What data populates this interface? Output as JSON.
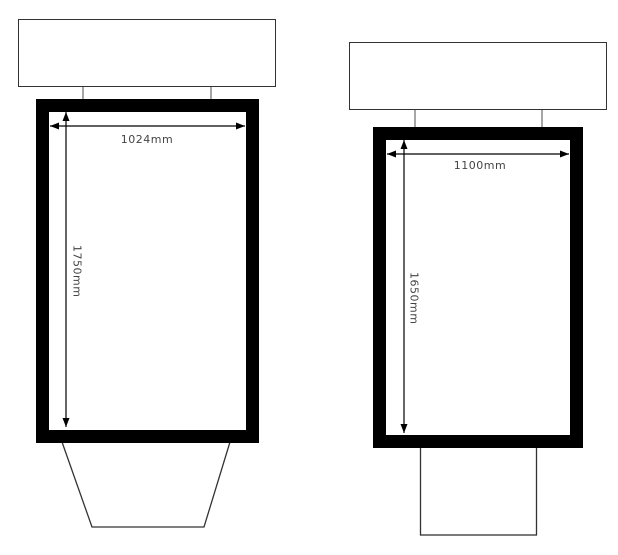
{
  "diagram": {
    "type": "technical-drawing",
    "description": "Front-view outline drawings of two display units with overall width and height dimensions",
    "colors": {
      "background": "#ffffff",
      "frame": "#000000",
      "outline": "#333333",
      "connector": "#a6a6a6",
      "dimension_line": "#000000",
      "label_text": "#444444"
    },
    "figures": [
      {
        "name": "left-unit",
        "width_label": "1024mm",
        "height_label": "1750mm"
      },
      {
        "name": "right-unit",
        "width_label": "1100mm",
        "height_label": "1650mm"
      }
    ]
  }
}
